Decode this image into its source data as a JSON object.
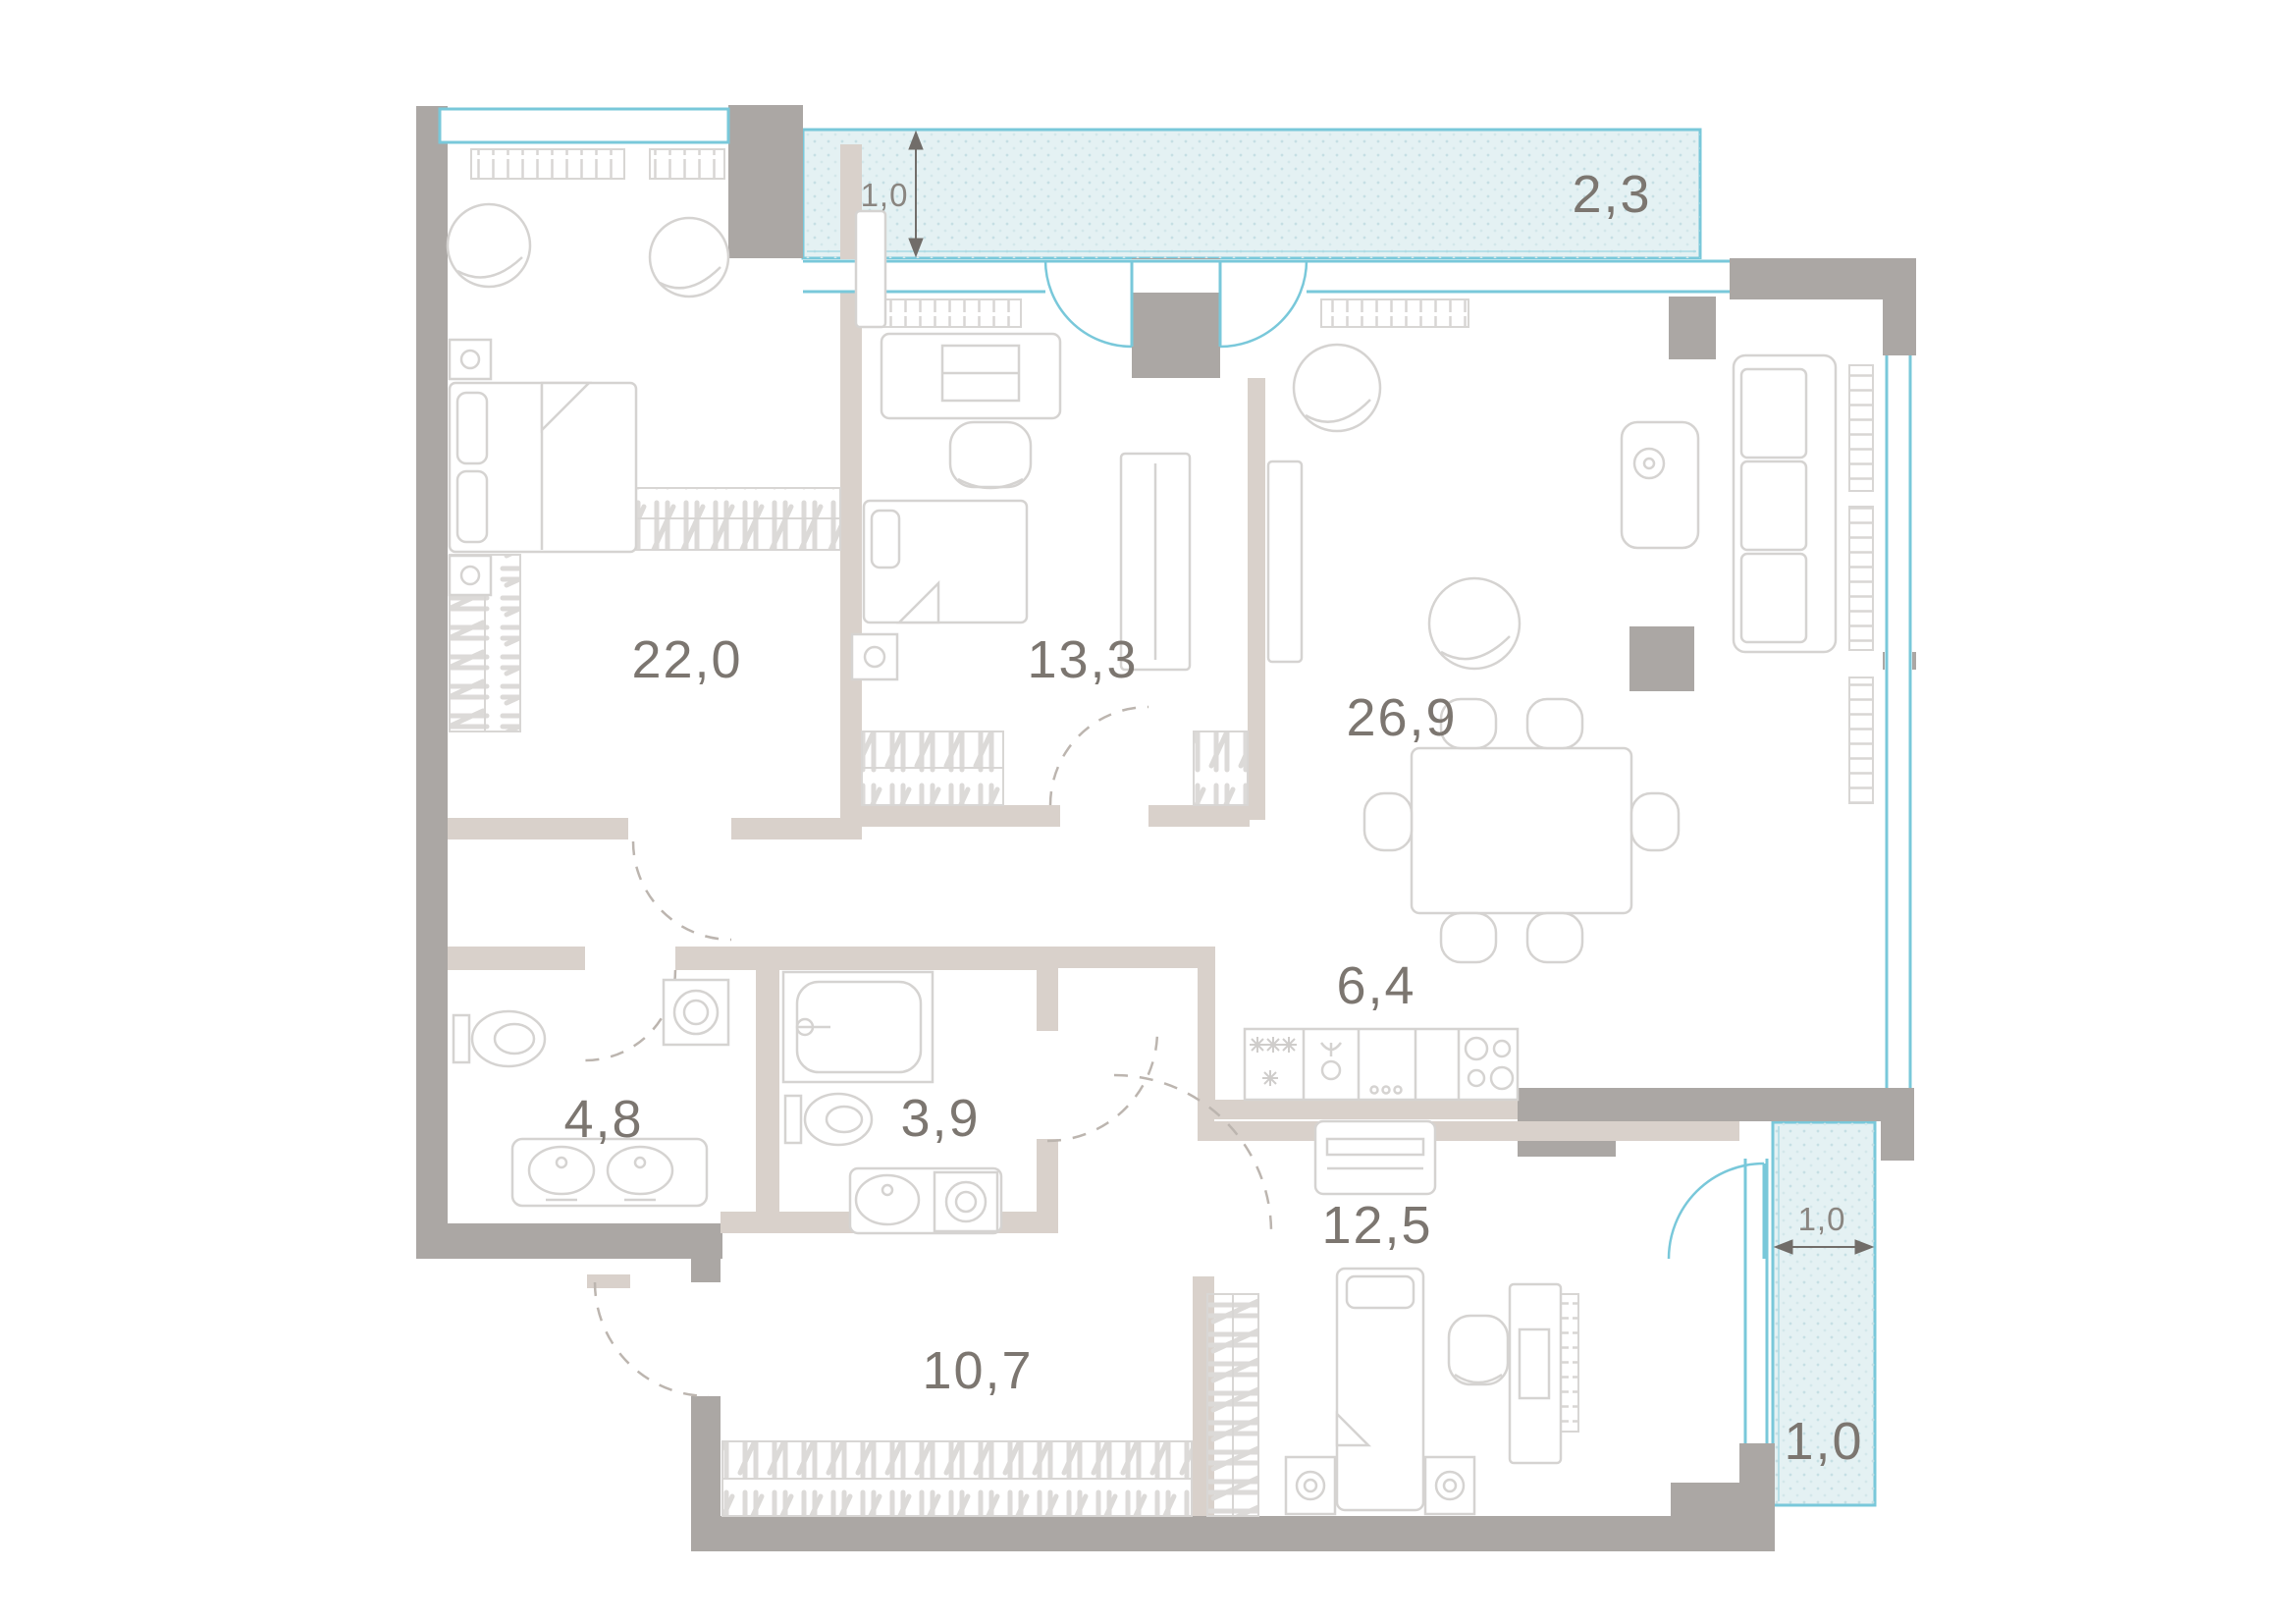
{
  "plan": {
    "type": "apartment-floor-plan",
    "rooms": [
      {
        "name": "bedroom-main",
        "area_m2": "22,0"
      },
      {
        "name": "bedroom-kids",
        "area_m2": "13,3"
      },
      {
        "name": "living-room",
        "area_m2": "26,9"
      },
      {
        "name": "kitchen-niche",
        "area_m2": "6,4"
      },
      {
        "name": "bathroom",
        "area_m2": "4,8"
      },
      {
        "name": "shower-room",
        "area_m2": "3,9"
      },
      {
        "name": "bedroom-small",
        "area_m2": "12,5"
      },
      {
        "name": "hallway",
        "area_m2": "10,7"
      }
    ],
    "balconies": [
      {
        "name": "balcony-top",
        "area_m2": "2,3",
        "depth_m": "1,0"
      },
      {
        "name": "balcony-side",
        "area_m2": "1,0",
        "width_m": "1,0"
      }
    ],
    "colors": {
      "exterior_wall": "#aba7a4",
      "partition_wall": "#d9d1cb",
      "window_blue": "#79c8da",
      "balcony_fill": "#e4f1f3",
      "furniture_line": "#d5d3d1",
      "label_text": "#7c7670",
      "dimension_text": "#8a8580"
    }
  }
}
